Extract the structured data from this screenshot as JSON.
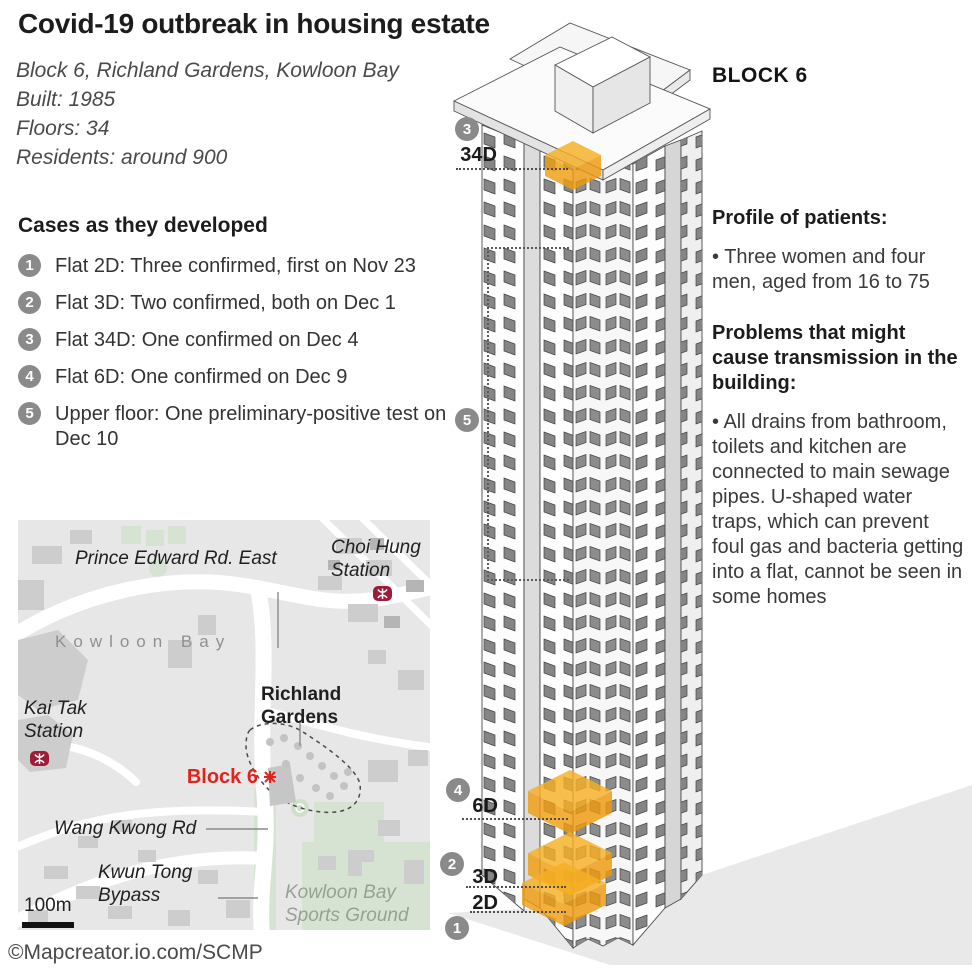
{
  "header": {
    "title": "Covid-19 outbreak in housing estate",
    "info": "Block 6, Richland Gardens, Kowloon Bay\nBuilt: 1985\nFloors: 34\nResidents: around 900"
  },
  "cases": {
    "heading": "Cases as they developed",
    "items": [
      {
        "num": "1",
        "text": "Flat 2D: Three confirmed, first on Nov 23"
      },
      {
        "num": "2",
        "text": "Flat 3D: Two confirmed, both on Dec 1"
      },
      {
        "num": "3",
        "text": "Flat 34D: One confirmed on Dec 4"
      },
      {
        "num": "4",
        "text": "Flat 6D: One confirmed on Dec 9"
      },
      {
        "num": "5",
        "text": "Upper floor: One preliminary-positive test on Dec 10"
      }
    ]
  },
  "building": {
    "name": "BLOCK 6",
    "markers": {
      "m1": "1",
      "m2": "2",
      "m3": "3",
      "m4": "4",
      "m5": "5"
    },
    "floor_labels": {
      "f34d": "34D",
      "f6d": "6D",
      "f3d": "3D",
      "f2d": "2D"
    }
  },
  "patients": {
    "heading": "Profile of patients:",
    "bullet": "• Three women and four men, aged from 16 to 75"
  },
  "problems": {
    "heading": "Problems that might cause transmission in the building:",
    "bullet": "• All drains from bathroom, toilets and kitchen are connected to main sewage pipes. U-shaped water traps, which can prevent foul gas and bacteria getting into a flat, cannot be seen in some homes"
  },
  "map": {
    "labels": {
      "prince_edward": "Prince Edward Rd. East",
      "choi_hung": "Choi Hung\nStation",
      "kowloon_bay": "Kowloon Bay",
      "kai_tak": "Kai Tak\nStation",
      "richland": "Richland\nGardens",
      "block6": "Block 6",
      "wang_kwong": "Wang Kwong Rd",
      "kwun_tong": "Kwun Tong\nBypass",
      "sports_ground": "Kowloon Bay\nSports Ground",
      "scale": "100m"
    }
  },
  "footer": {
    "credit": "©Mapcreator.io.com/SCMP"
  },
  "colors": {
    "highlight_orange": "#f5a81f",
    "marker_gray": "#8a8a8a",
    "block6_red": "#e0231c",
    "mtr_red": "#9d1c37",
    "map_bg": "#e7e7e7",
    "green": "#d7e3d2"
  }
}
